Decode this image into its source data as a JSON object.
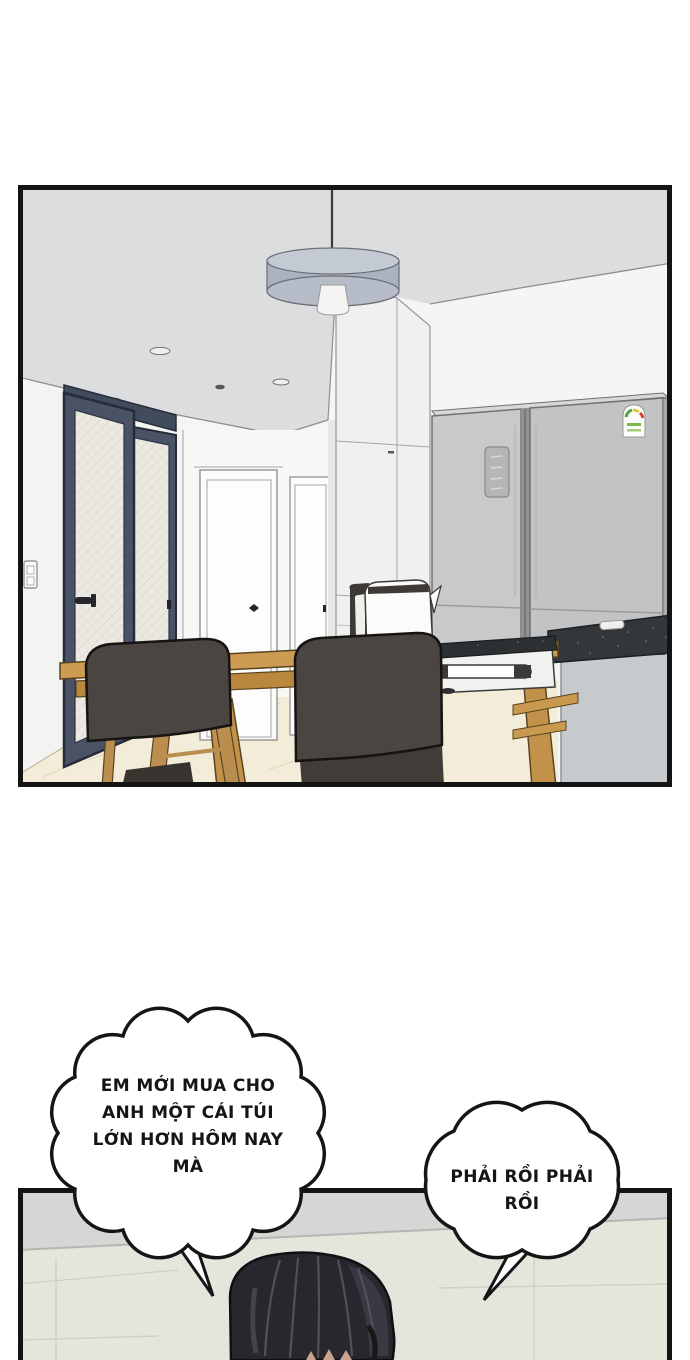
{
  "bubbles": [
    {
      "lines": [
        "EM MỚI MUA CHO",
        "ANH MỘT CÁI TÚI",
        "LỚN HƠN HÔM NAY",
        "MÀ"
      ]
    },
    {
      "lines": [
        "PHẢI RỒI PHẢI",
        "RỒI"
      ]
    }
  ],
  "colors": {
    "panel_border": "#141414",
    "ceiling": "#dcddde",
    "wall": "#f5f5f3",
    "door_navy": "#4a5366",
    "glass": "#ebe9e1",
    "fridge_left_door": "#c7c9cb",
    "fridge_right_door": "#c1c3c5",
    "table_wood": "#cd9c52",
    "chair_dark": "#4a4540",
    "floor": "#f2ecd8",
    "counter_top": "#34373a",
    "counter_base": "#c7cacc",
    "tile_wall": "#e4e6dc",
    "hair": "#27272d"
  }
}
